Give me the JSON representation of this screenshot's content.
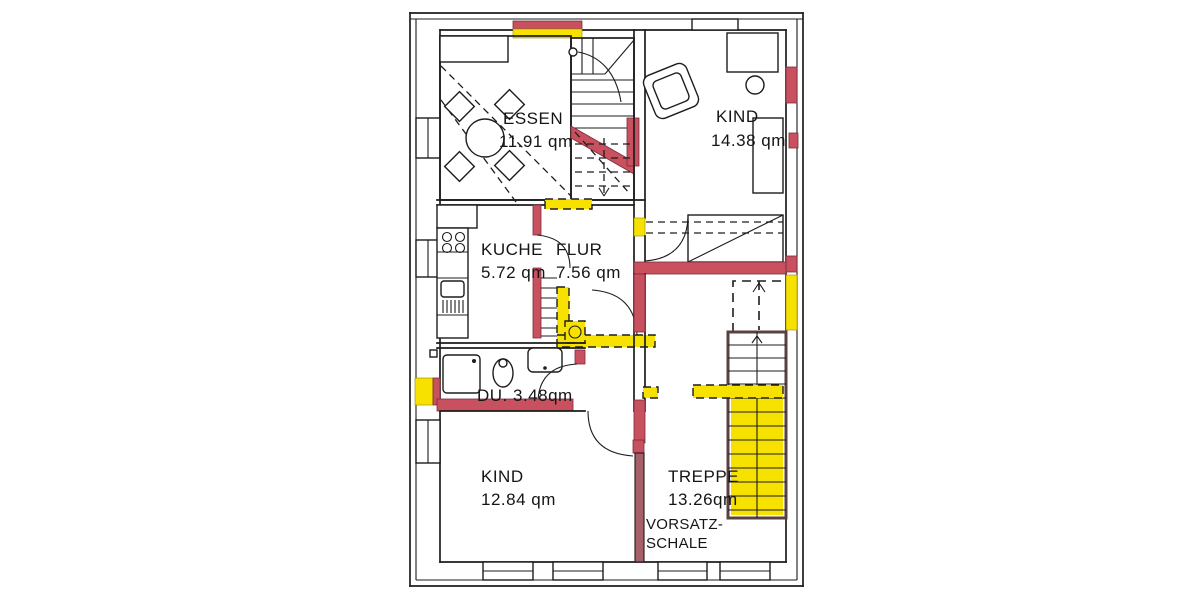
{
  "document": {
    "type": "floor-plan",
    "style": "scanned renovation blueprint"
  },
  "colors": {
    "paper": "#ffffff",
    "line": "#1d1d1d",
    "new_wall_red": "#c8505f",
    "highlight_yellow": "#f6e100"
  },
  "rooms": {
    "essen": {
      "name": "ESSEN",
      "area": "11.91 qm"
    },
    "kind_top": {
      "name": "KIND",
      "area": "14.38 qm"
    },
    "kueche": {
      "name": "KUCHE",
      "area": "5.72 qm"
    },
    "flur": {
      "name": "FLUR",
      "area": "7.56 qm"
    },
    "dusche": {
      "label": "DU. 3.48qm"
    },
    "kind_bottom": {
      "name": "KIND",
      "area": "12.84 qm"
    },
    "treppe": {
      "name": "TREPPE",
      "area": "13.26qm"
    }
  },
  "annotations": {
    "vorsatzschale_line1": "VORSATZ-",
    "vorsatzschale_line2": "SCHALE"
  }
}
